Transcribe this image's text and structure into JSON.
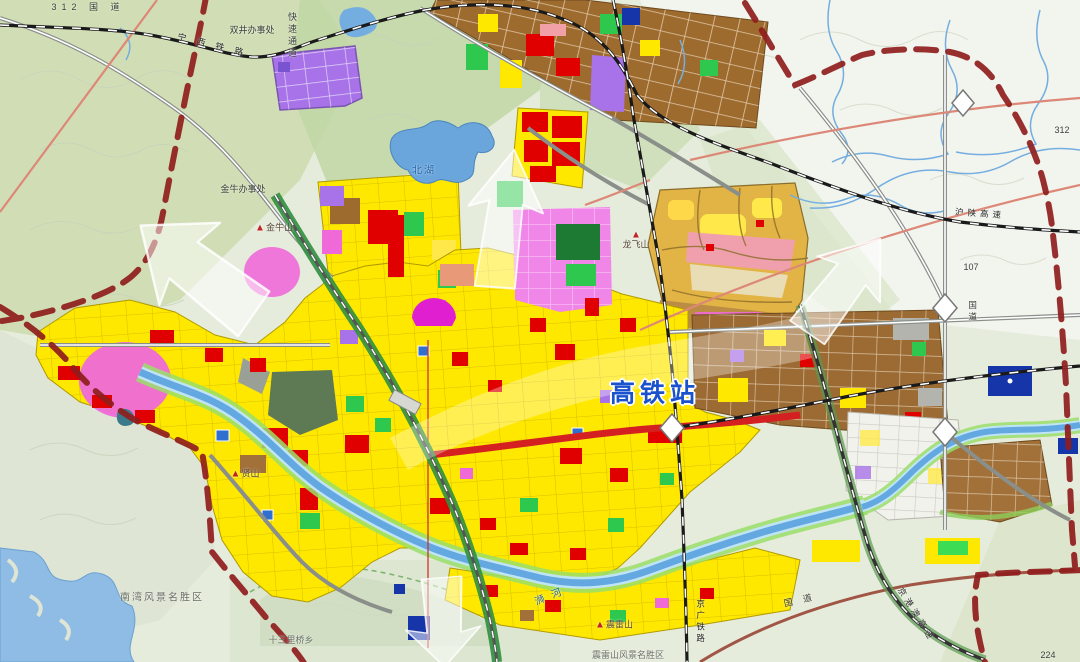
{
  "map_title": "城市总体规划图（高铁站片区）",
  "labels": {
    "g312_west": "312 国 道",
    "ningxi_railway": "宁 西 铁 路",
    "shuangjing_office": "双井办事处",
    "expressway_v": "快速通道",
    "jinniu_office": "金牛办事处",
    "jinniu_mountain": "金牛山",
    "north_lake": "北湖",
    "longfei_mountain": "龙飞山",
    "hsr_station": "高铁站",
    "xian_mountain": "贤山",
    "nanwan_scenic": "南湾风景名胜区",
    "shisanliqiao": "十三里桥乡",
    "shi_river": "浉河",
    "zhenlei_mountain": "震雷山",
    "zhenlei_scenic": "震雷山风景名胜区",
    "jingguang_railway": "京广铁路",
    "jinggangao_expwy": "京港澳高速",
    "hushan_expwy": "沪陕高速",
    "g107": "107",
    "g107_road": "国道",
    "g312_east": "312",
    "g107_southeast": "国 道",
    "n224": "224"
  },
  "glyphs": {
    "mountain_triangle": "▲"
  },
  "colors": {
    "boundary": "#8f1d1d",
    "residential_yellow": "#ffe800",
    "commercial_red": "#e00000",
    "industrial_brown": "#9e6b2e",
    "special_purple": "#a873e8",
    "mixed_magenta": "#ef6ad8",
    "park_green": "#2ec84e",
    "water_blue": "#74aee0",
    "golden_zone": "#e2b345",
    "station_label_blue": "#1952cc",
    "arrow_white": "#ffffff"
  }
}
